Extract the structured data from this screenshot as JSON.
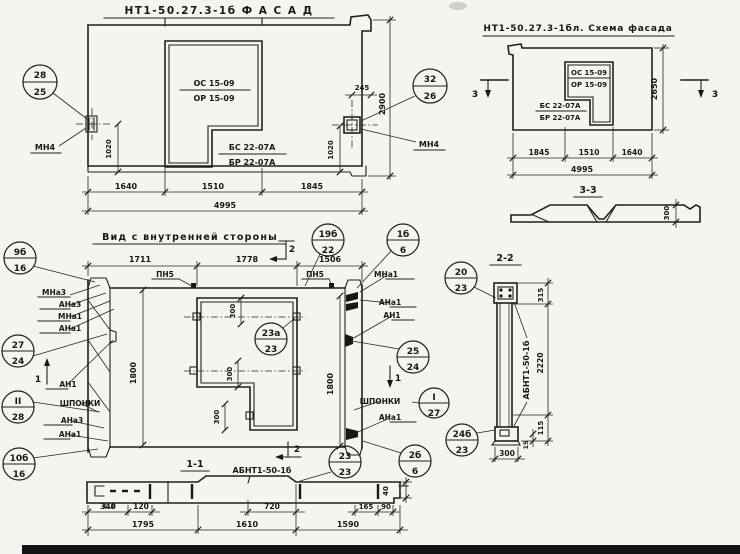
{
  "facade": {
    "title": "НТ1-50.27.3-1б  Ф А С А Д",
    "os": "ОС 15-09",
    "or": "ОР 15-09",
    "bs": "БС 22-07А",
    "br": "БР 22-07А",
    "mn4_left": "МН4",
    "mn4_right": "МН4",
    "callout_left": {
      "top": "28",
      "bottom": "25"
    },
    "callout_right": {
      "top": "32",
      "bottom": "26"
    },
    "dims": {
      "d245": "245",
      "h2900": "2900",
      "v1020l": "1020",
      "v1020r": "1020",
      "b1": "1640",
      "b2": "1510",
      "b3": "1845",
      "total": "4995"
    }
  },
  "schema": {
    "title": "НТ1-50.27.3-1бл. Схема фасада",
    "os": "ОС 15-09",
    "or": "ОР 15-09",
    "bs": "БС 22-07А",
    "br": "БР 22-07А",
    "marker_left": "3",
    "marker_right": "3",
    "dims": {
      "h2650": "2650",
      "b1": "1845",
      "b2": "1510",
      "b3": "1640",
      "total": "4995"
    },
    "section_ref": "3-3"
  },
  "section33": {
    "dim300": "300"
  },
  "internal": {
    "title": "Вид с внутренней стороны",
    "dims_top": [
      "1711",
      "1778",
      "1506"
    ],
    "pn5a": "ПН5",
    "pn5b": "ПН5",
    "left_labels": [
      "МНа3",
      "АНа3",
      "МНа1",
      "АНа1",
      "АН1",
      "ШПОНКИ",
      "АНа3",
      "АНа1"
    ],
    "right_labels": [
      "МНа1",
      "АНа1",
      "АН1",
      "ШПОНКИ",
      "АНа1"
    ],
    "marker1_left": "1",
    "marker1_right": "1",
    "marker2_top": "2",
    "marker2_bottom": "2",
    "dim300a": "300",
    "dim300b": "300",
    "dim300c": "300",
    "dim1800l": "1800",
    "dim1800r": "1800",
    "callouts": {
      "c9b16": {
        "top": "9б",
        "bottom": "16"
      },
      "c27_24": {
        "top": "27",
        "bottom": "24"
      },
      "cII_28": {
        "top": "II",
        "bottom": "28"
      },
      "c10b16": {
        "top": "10б",
        "bottom": "16"
      },
      "c19b22": {
        "top": "19б",
        "bottom": "22"
      },
      "c23a23": {
        "top": "23а",
        "bottom": "23"
      },
      "c1b6": {
        "top": "1б",
        "bottom": "6"
      },
      "c25_24": {
        "top": "25",
        "bottom": "24"
      },
      "cI_27": {
        "top": "I",
        "bottom": "27"
      },
      "c2b6": {
        "top": "2б",
        "bottom": "6"
      }
    }
  },
  "section11": {
    "title": "1-1",
    "part": "АБНТ1-50-1б",
    "callout": {
      "top": "23",
      "bottom": "23"
    },
    "dims": {
      "d340": "340",
      "d120": "120",
      "d720": "720",
      "d165": "165",
      "d90": "90",
      "b1": "1795",
      "b2": "1610",
      "b3": "1590",
      "d40": "40"
    }
  },
  "section22": {
    "title": "2-2",
    "part": "АБНТ1-50-1б",
    "callout_top": {
      "top": "20",
      "bottom": "23"
    },
    "callout_bottom": {
      "top": "24б",
      "bottom": "23"
    },
    "dims": {
      "d315": "315",
      "d2220": "2220",
      "d115": "115",
      "d15": "15",
      "d300": "300"
    }
  }
}
